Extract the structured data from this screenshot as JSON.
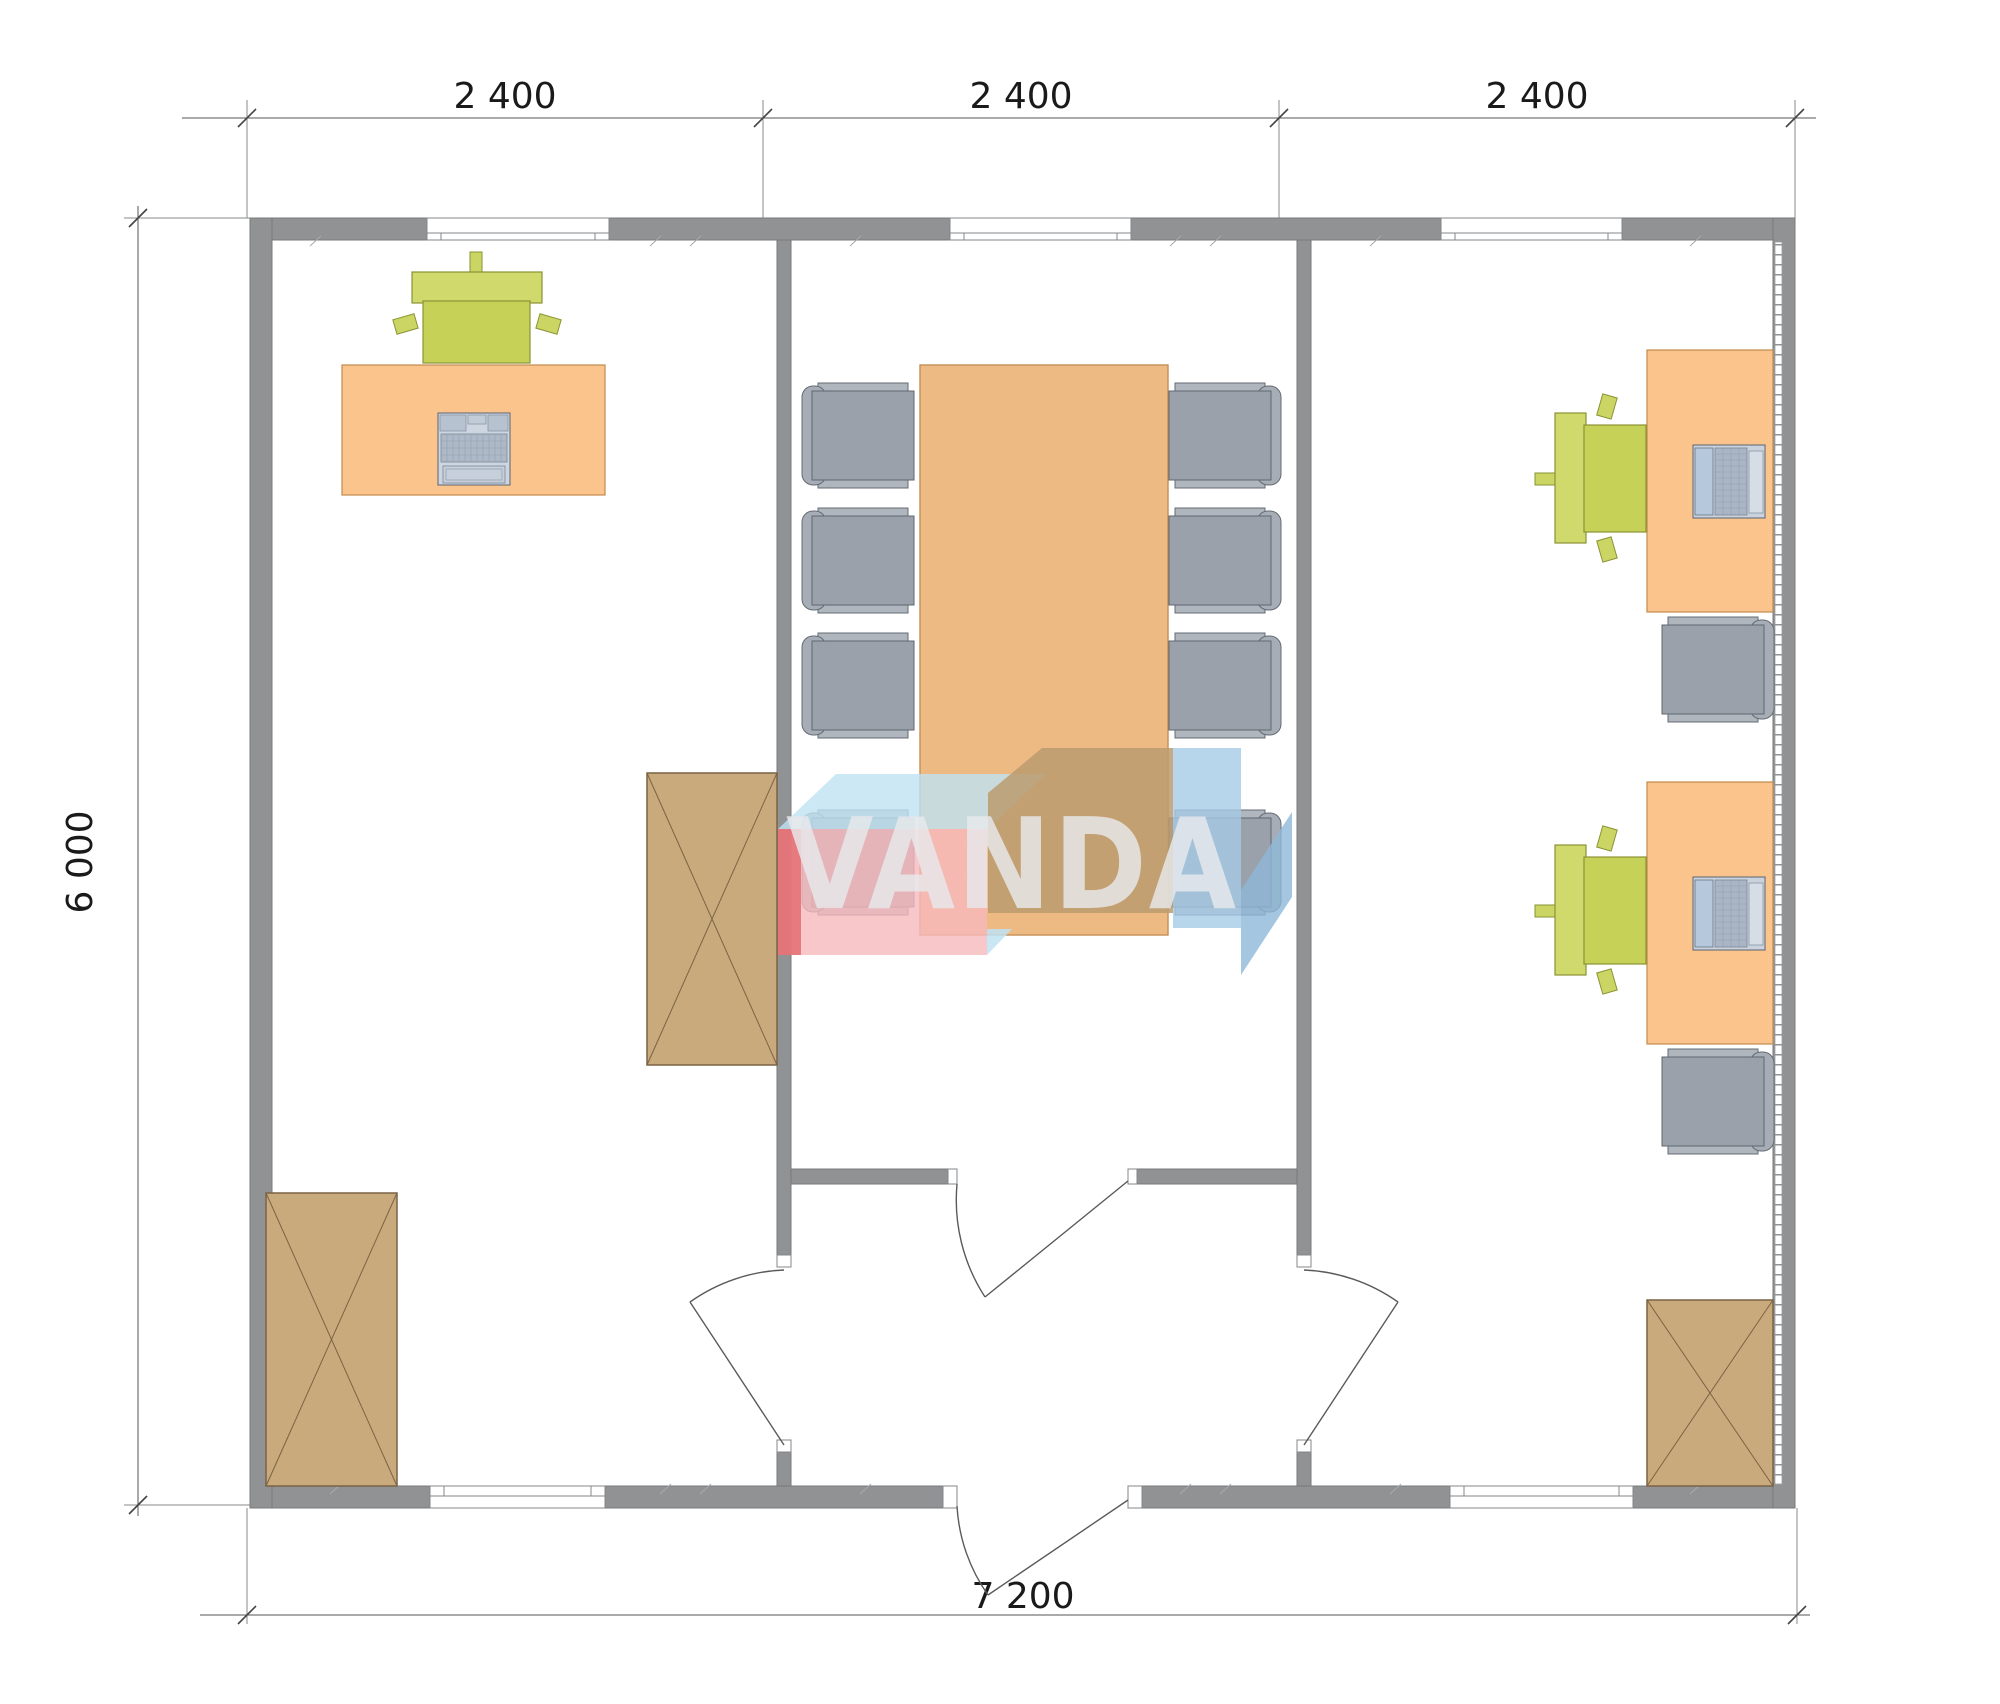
{
  "drawing": {
    "type": "architectural-floor-plan",
    "watermark": "VANDA",
    "dimensions": {
      "top": [
        "2 400",
        "2 400",
        "2 400"
      ],
      "left": "6 000",
      "bottom": "7 200"
    },
    "rooms": [
      {
        "name": "left-office",
        "furniture": [
          "desk",
          "office-chair",
          "desktop-computer",
          "cabinet",
          "cabinet"
        ]
      },
      {
        "name": "meeting-room",
        "furniture": [
          "conference-table",
          "chair",
          "chair",
          "chair",
          "chair",
          "chair",
          "chair",
          "chair",
          "chair"
        ]
      },
      {
        "name": "right-office",
        "furniture": [
          "desk",
          "desk",
          "laptop",
          "laptop",
          "office-chair",
          "office-chair",
          "task-chair",
          "task-chair",
          "cabinet"
        ]
      },
      {
        "name": "entrance-vestibule",
        "furniture": []
      }
    ],
    "doors": [
      "entrance-door",
      "vestibule-to-middle-room-door",
      "vestibule-to-left-room-door",
      "vestibule-to-right-room-door"
    ],
    "windows": [
      "top-left",
      "top-middle",
      "top-right",
      "bottom-left",
      "bottom-right"
    ],
    "colors": {
      "wall": "#909294",
      "wall_edge": "#77797c",
      "desk": "#fbc48c",
      "desk_edge": "#c08a4e",
      "chair_green": "#cbd563",
      "chair_green_edge": "#8a9334",
      "chair_gray": "#9aa1ab",
      "chair_gray_edge": "#5f6770",
      "cabinet": "#c9aa7d",
      "cabinet_edge": "#7a6344",
      "dimension_text": "#1a1a1a",
      "watermark_red": "#e2666c",
      "watermark_pink": "#f6b9bd",
      "watermark_skyblue": "#bfe2f2",
      "watermark_blue": "#a5cbe6",
      "watermark_blue_dark": "#8fb8d8",
      "watermark_tan": "#bb9b6e",
      "watermark_text": "#e8e9ec"
    }
  }
}
